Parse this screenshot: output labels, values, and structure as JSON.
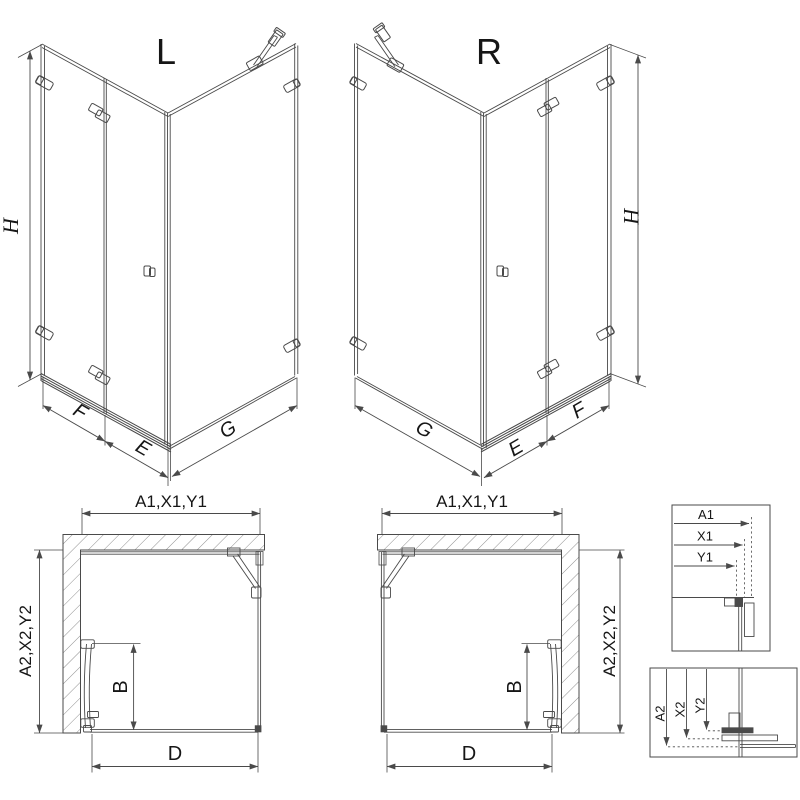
{
  "figure": {
    "iso_views": [
      {
        "variant": "L",
        "dim_height": "H",
        "dim_fixed": "F",
        "dim_door": "E",
        "dim_side": "G"
      },
      {
        "variant": "R",
        "dim_height": "H",
        "dim_fixed": "F",
        "dim_door": "E",
        "dim_side": "G"
      }
    ],
    "plan_views": [
      {
        "dim_width": "A1,X1,Y1",
        "dim_depth": "A2,X2,Y2",
        "dim_door": "B",
        "dim_entry": "D"
      },
      {
        "dim_width": "A1,X1,Y1",
        "dim_depth": "A2,X2,Y2",
        "dim_door": "B",
        "dim_entry": "D"
      }
    ],
    "detail_views": [
      {
        "dims": [
          "A1",
          "X1",
          "Y1"
        ]
      },
      {
        "dims": [
          "A2",
          "X2",
          "Y2"
        ]
      }
    ]
  },
  "colors": {
    "line": "#4a4a4a",
    "text": "#161616",
    "hatch": "#8f8f8f",
    "bg": "#ffffff"
  }
}
